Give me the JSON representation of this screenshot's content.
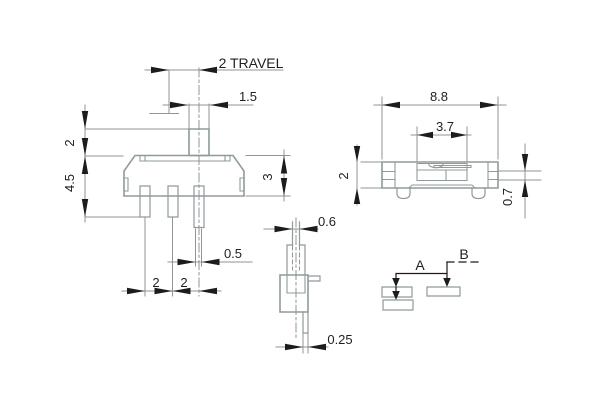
{
  "colors": {
    "outline": "#8f9a9b",
    "dimension": "#8f9494",
    "arrow": "#1c1c1c",
    "text": "#1f1f1f",
    "background": "#ffffff"
  },
  "front_view": {
    "travel": "2 TRAVEL",
    "knob_width": "1.5",
    "knob_height": "2",
    "overall_height": "4.5",
    "body_height": "3",
    "terminal_width": "0.5",
    "pitch_left": "2",
    "pitch_right": "2"
  },
  "top_view": {
    "body_width": "8.8",
    "slot_width": "3.7",
    "body_depth": "2",
    "terminal_thickness": "0.7"
  },
  "side_view": {
    "actuator_thickness": "0.6",
    "terminal_thickness": "0.25"
  },
  "positions": {
    "a": "A",
    "b": "B"
  }
}
